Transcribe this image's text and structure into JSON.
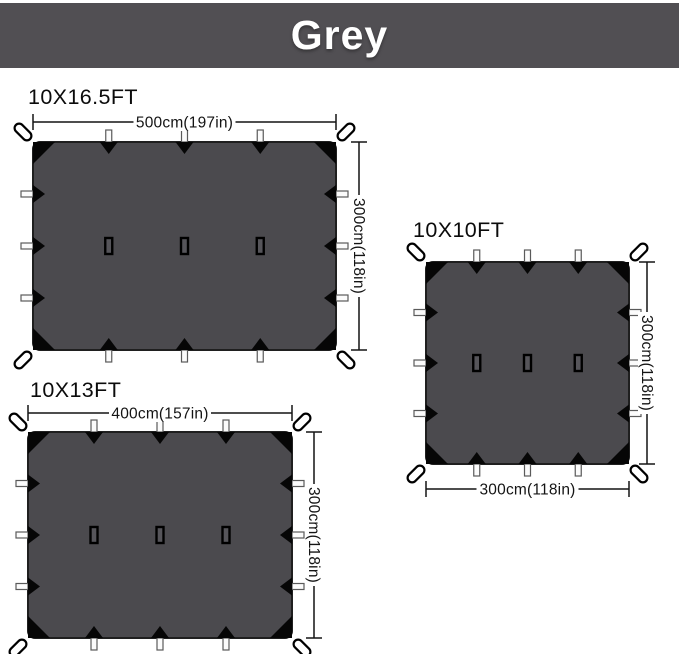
{
  "banner": {
    "label": "Grey"
  },
  "colors": {
    "banner_bg": "#514f53",
    "banner_text": "#ffffff",
    "tarp_fill": "#4b4a4e",
    "tarp_stroke": "#1f1f1f",
    "tie_color": "#060606",
    "tab_fill": "#fbfbfb",
    "tab_stroke": "#5a5a5a",
    "loop_fill": "#ffffff",
    "loop_stroke": "#000000",
    "slot_fill": "#56555a",
    "dim_color": "#141414"
  },
  "tarps": [
    {
      "name": "10x16-5ft",
      "label": "10X16.5FT",
      "width_label": "500cm(197in)",
      "height_label": "300cm(118in)",
      "label_pos": {
        "x": 28,
        "y": 104
      },
      "rect": {
        "x": 33,
        "y": 142,
        "w": 303,
        "h": 208
      },
      "width_dim": {
        "side": "top",
        "offset_y": 122
      },
      "height_dim": {
        "side": "right",
        "offset_x": 359
      }
    },
    {
      "name": "10x10ft",
      "label": "10X10FT",
      "width_label": "300cm(118in)",
      "height_label": "300cm(118in)",
      "label_pos": {
        "x": 413,
        "y": 237
      },
      "rect": {
        "x": 426,
        "y": 262,
        "w": 203,
        "h": 202
      },
      "width_dim": {
        "side": "bottom",
        "offset_y": 489
      },
      "height_dim": {
        "side": "right",
        "offset_x": 647
      }
    },
    {
      "name": "10x13ft",
      "label": "10X13FT",
      "width_label": "400cm(157in)",
      "height_label": "300cm(118in)",
      "label_pos": {
        "x": 30,
        "y": 397
      },
      "rect": {
        "x": 28,
        "y": 432,
        "w": 264,
        "h": 206
      },
      "width_dim": {
        "side": "top",
        "offset_y": 413
      },
      "height_dim": {
        "side": "right",
        "offset_x": 314
      }
    }
  ]
}
